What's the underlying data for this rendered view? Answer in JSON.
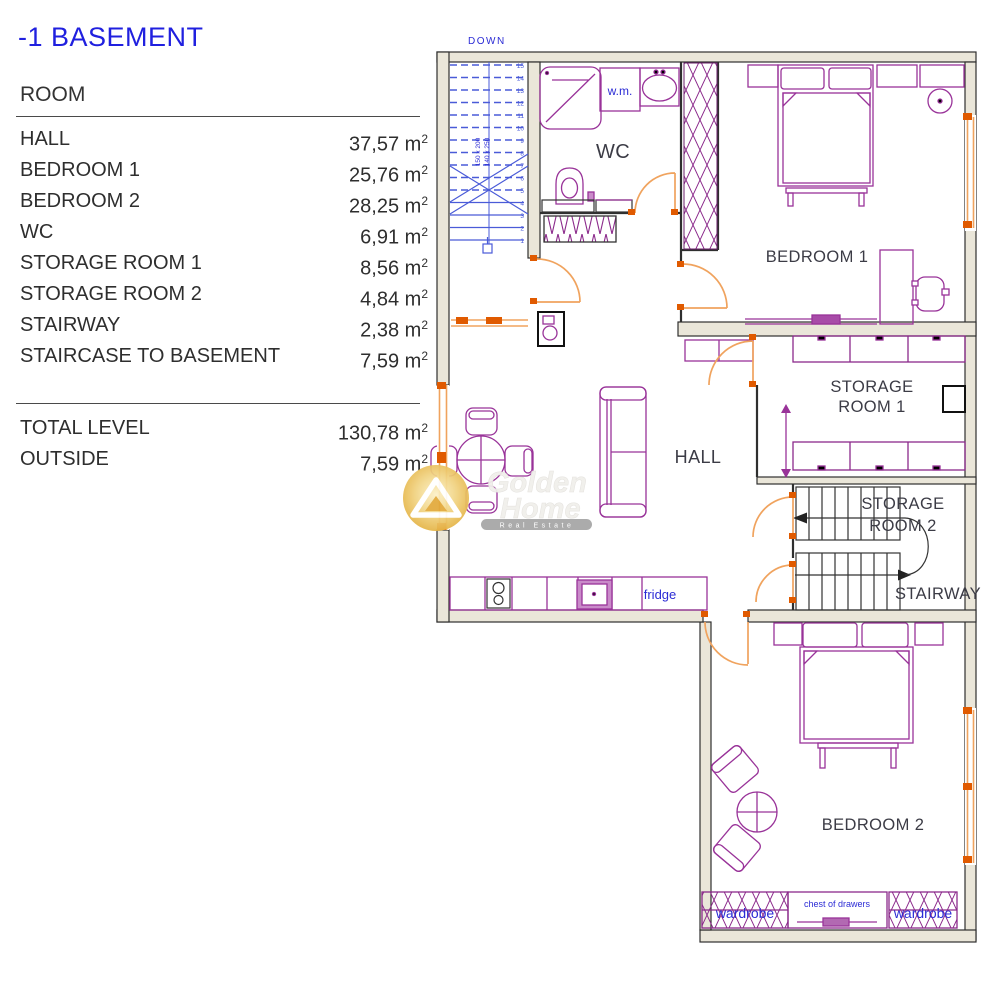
{
  "legend": {
    "title": "-1 BASEMENT",
    "column_header": "ROOM",
    "unit": "m",
    "unit_exp": "2",
    "rooms": [
      {
        "name": "HALL",
        "area": "37,57"
      },
      {
        "name": "BEDROOM 1",
        "area": "25,76"
      },
      {
        "name": "BEDROOM 2",
        "area": "28,25"
      },
      {
        "name": "WC",
        "area": "6,91"
      },
      {
        "name": "STORAGE ROOM 1",
        "area": "8,56"
      },
      {
        "name": "STORAGE ROOM 2",
        "area": "4,84"
      },
      {
        "name": "STAIRWAY",
        "area": "2,38"
      },
      {
        "name": "STAIRCASE TO BASEMENT",
        "area": "7,59"
      }
    ],
    "totals": [
      {
        "name": "TOTAL LEVEL",
        "area": "130,78"
      },
      {
        "name": "OUTSIDE",
        "area": "7,59"
      }
    ]
  },
  "plan": {
    "rooms": {
      "wc": "WC",
      "hall": "HALL",
      "bedroom1": "BEDROOM 1",
      "bedroom2": "BEDROOM 2",
      "storage1_line1": "STORAGE",
      "storage1_line2": "ROOM 1",
      "storage2_line1": "STORAGE",
      "storage2_line2": "ROOM 2",
      "stairway": "STAIRWAY"
    },
    "small_labels": {
      "washing_machine": "w.m.",
      "fridge": "fridge",
      "wardrobe_left": "wardrobe",
      "wardrobe_right": "wardrobe",
      "chest_of_drawers": "chest of drawers"
    },
    "stairs_basement": {
      "direction_label": "DOWN",
      "dimension_label_1": "150 x 200",
      "dimension_label_2": "140 x 250",
      "numbers": [
        "15",
        "14",
        "13",
        "12",
        "11",
        "10",
        "9",
        "8",
        "7",
        "6",
        "5",
        "4",
        "3",
        "2",
        "1"
      ]
    },
    "watermark": {
      "brand_line1": "Golden",
      "brand_line2": "Home",
      "tagline": "Real Estate"
    },
    "colors": {
      "furniture": "#993399",
      "doors_windows": "#F0A35E",
      "marker": "#E05A00",
      "stairs_blue": "#4A5BD8",
      "labels_blue": "#2B2BD5",
      "wall_fill": "#EAE6D9",
      "wall_stroke": "#2F2F2F",
      "room_label": "#3C3C46",
      "title_blue": "#2020DF",
      "gold": "#E8B43C"
    }
  }
}
